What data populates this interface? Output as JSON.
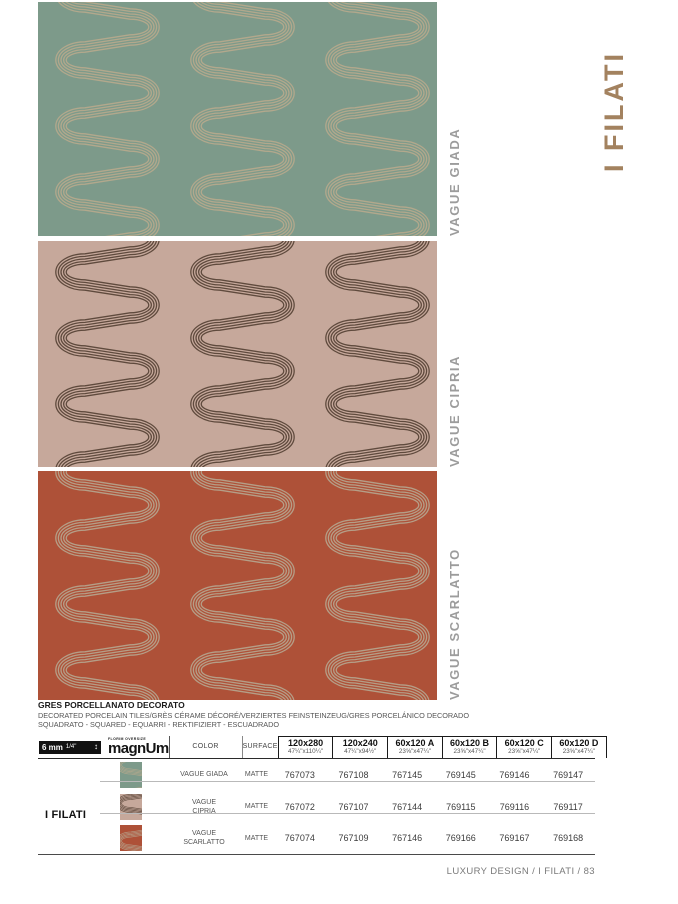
{
  "page_title": "I FILATI",
  "panels": [
    {
      "label": "VAGUE GIADA",
      "bg": "#7d9a8a",
      "line": "#b2a88c"
    },
    {
      "label": "VAGUE CIPRIA",
      "bg": "#c6a89b",
      "line": "#5f4a3d"
    },
    {
      "label": "VAGUE SCARLATTO",
      "bg": "#ae5138",
      "line": "#b59e87"
    }
  ],
  "description": {
    "title": "GRES PORCELLANATO DECORATO",
    "line1": "DECORATED PORCELAIN TILES/GRÈS CÉRAME DÉCORÉ/VERZIERTES FEINSTEINZEUG/GRES PORCELÁNICO DECORADO",
    "line2": "SQUADRATO - SQUARED - EQUARRI - REKTIFIZIERT - ESCUADRADO"
  },
  "table": {
    "thickness_mm": "6 mm",
    "thickness_in": "1/4\"",
    "brand_small": "FLORIM OVERSIZE",
    "brand": "magnUm",
    "color_header": "COLOR",
    "surface_header": "SURFACE",
    "sizes": [
      {
        "cm": "120x280",
        "in": "47¼\"x110¼\""
      },
      {
        "cm": "120x240",
        "in": "47¼\"x94½\""
      },
      {
        "cm": "60x120 A",
        "in": "23⅝\"x47¼\""
      },
      {
        "cm": "60x120 B",
        "in": "23⅝\"x47¼\""
      },
      {
        "cm": "60x120 C",
        "in": "23⅝\"x47¼\""
      },
      {
        "cm": "60x120 D",
        "in": "23⅝\"x47¼\""
      }
    ],
    "group_label": "I FILATI",
    "rows": [
      {
        "color": "VAGUE GIADA",
        "surface": "MATTE",
        "codes": [
          "767073",
          "767108",
          "767145",
          "769145",
          "769146",
          "769147"
        ]
      },
      {
        "color": "VAGUE CIPRIA",
        "surface": "MATTE",
        "codes": [
          "767072",
          "767107",
          "767144",
          "769115",
          "769116",
          "769117"
        ]
      },
      {
        "color": "VAGUE SCARLATTO",
        "surface": "MATTE",
        "codes": [
          "767074",
          "767109",
          "767146",
          "769166",
          "769167",
          "769168"
        ]
      }
    ]
  },
  "footer": "LUXURY DESIGN / I FILATI / 83"
}
